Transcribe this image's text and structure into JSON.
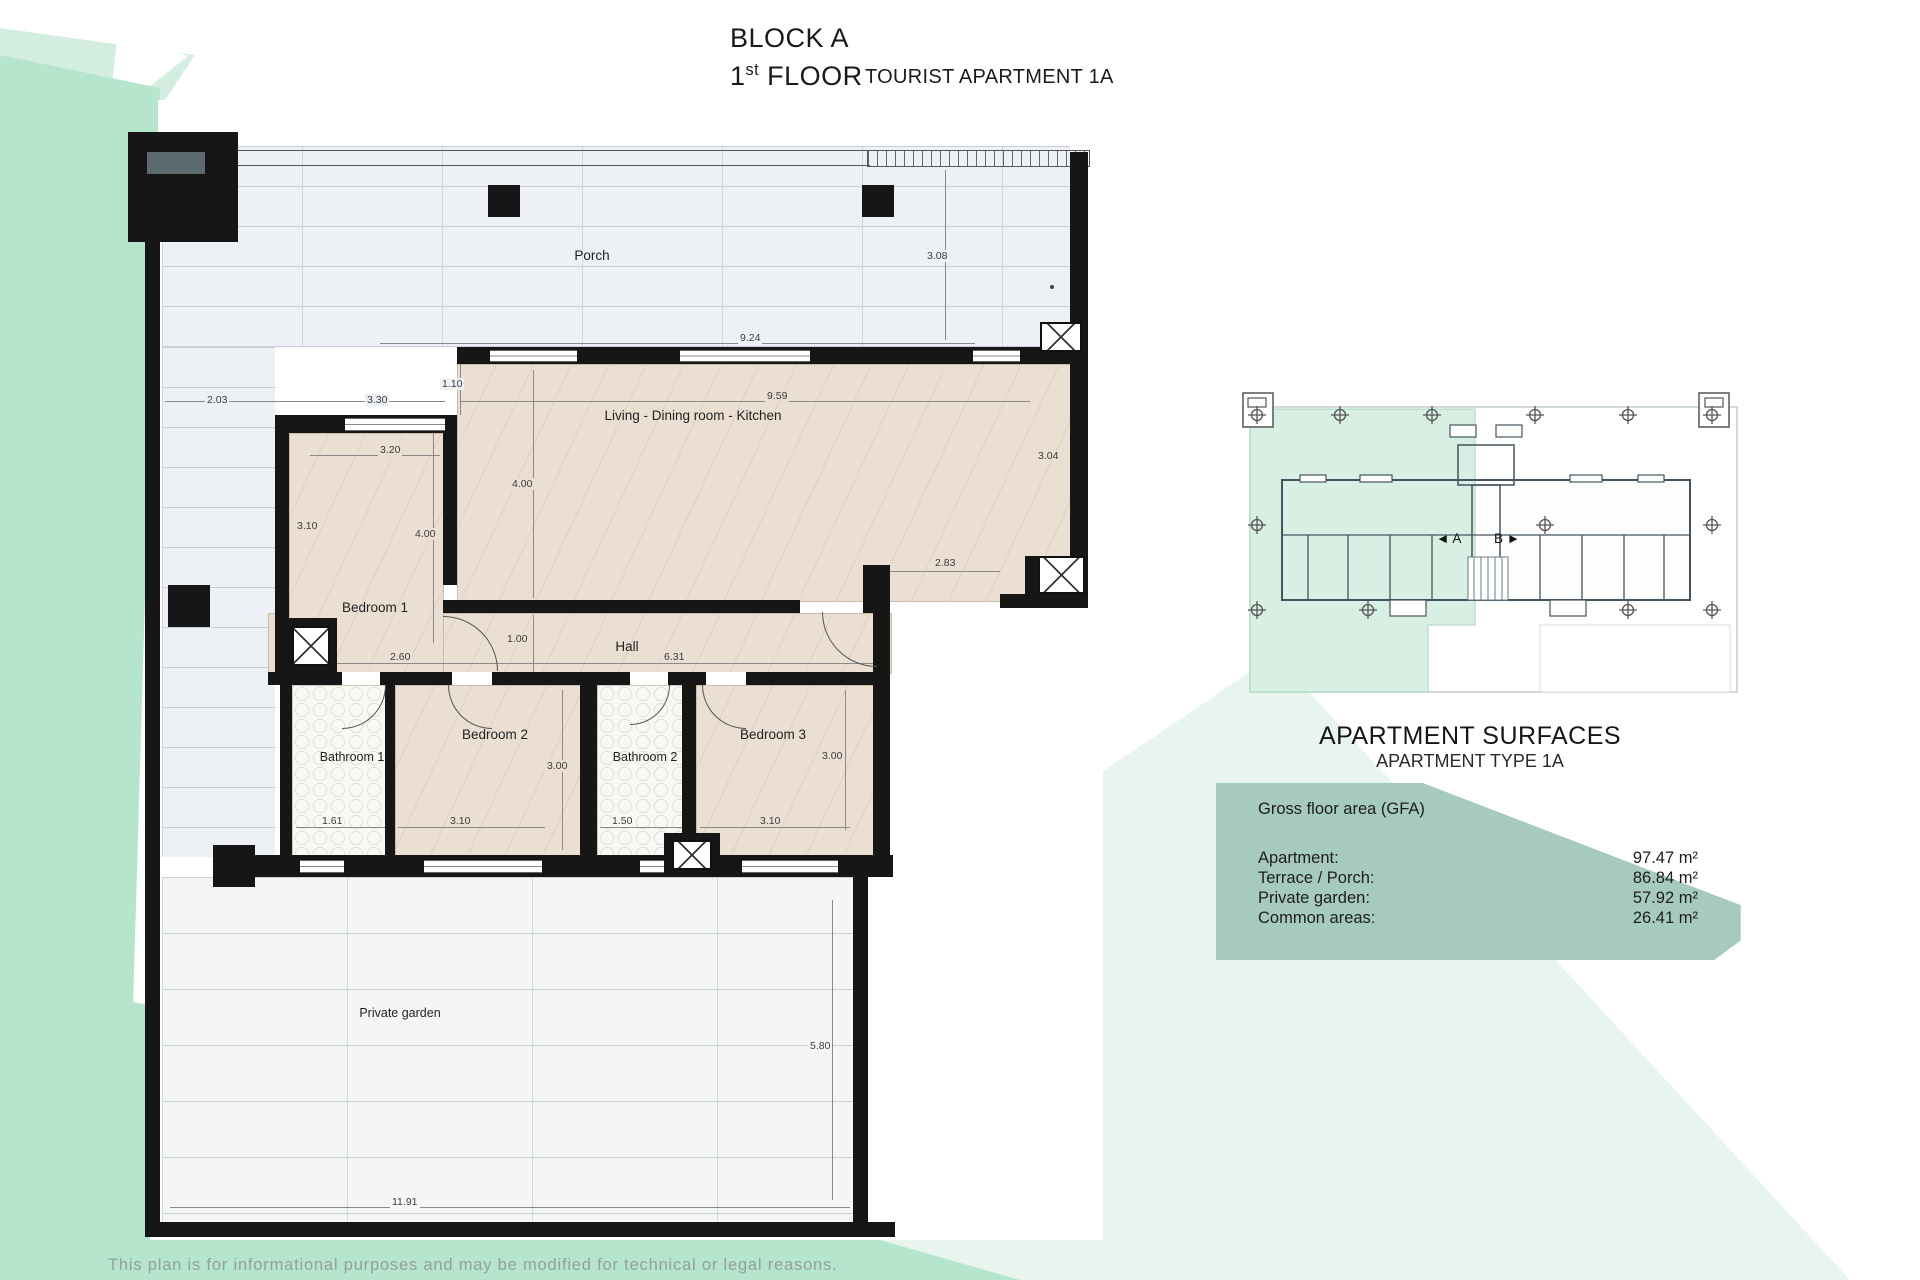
{
  "title": {
    "block": "BLOCK A",
    "floor_num": "1",
    "floor_sup": "st",
    "floor_rest": " FLOOR",
    "apartment": "TOURIST APARTMENT 1A"
  },
  "plan": {
    "rooms": {
      "porch": "Porch",
      "living": "Living - Dining room - Kitchen",
      "bedroom1": "Bedroom 1",
      "hall": "Hall",
      "bathroom1": "Bathroom 1",
      "bedroom2": "Bedroom 2",
      "bathroom2": "Bathroom 2",
      "bedroom3": "Bedroom 3",
      "garden": "Private garden"
    },
    "dims": {
      "d203": "2.03",
      "d330": "3.30",
      "d110": "1.10",
      "d924": "9.24",
      "d308": "3.08",
      "d959": "9.59",
      "d320": "3.20",
      "d310b1": "3.10",
      "d400b1": "4.00",
      "d400lv": "4.00",
      "d304": "3.04",
      "d283": "2.83",
      "d100": "1.00",
      "d260": "2.60",
      "d631": "6.31",
      "d161": "1.61",
      "d310b2": "3.10",
      "d300b2": "3.00",
      "d150": "1.50",
      "d310b3": "3.10",
      "d300b3": "3.00",
      "d580": "5.80",
      "d1191": "11.91"
    }
  },
  "overview": {
    "label_a": "◄ A",
    "label_b": "B ►"
  },
  "surfaces": {
    "title": "APARTMENT SURFACES",
    "subtitle": "APARTMENT TYPE 1A",
    "gfa_label": "Gross floor area (GFA)",
    "rows": [
      {
        "label": "Apartment:",
        "value": "97.47 m²"
      },
      {
        "label": "Terrace / Porch:",
        "value": "86.84 m²"
      },
      {
        "label": "Private garden:",
        "value": "57.92 m²"
      },
      {
        "label": "Common areas:",
        "value": "26.41 m²"
      }
    ]
  },
  "footer": {
    "disclaimer": "This plan is for informational purposes and may be modified for technical or legal reasons."
  },
  "colors": {
    "mint": "#b6e5cd",
    "mint_light": "#d3eee1",
    "mint_faint": "#e8f5ee",
    "panel_green": "#a6cabb",
    "wall": "#161616",
    "floor_beige": "#eadfd2",
    "porch_floor": "#edf1f5",
    "garden_floor": "#f4f6f5"
  }
}
